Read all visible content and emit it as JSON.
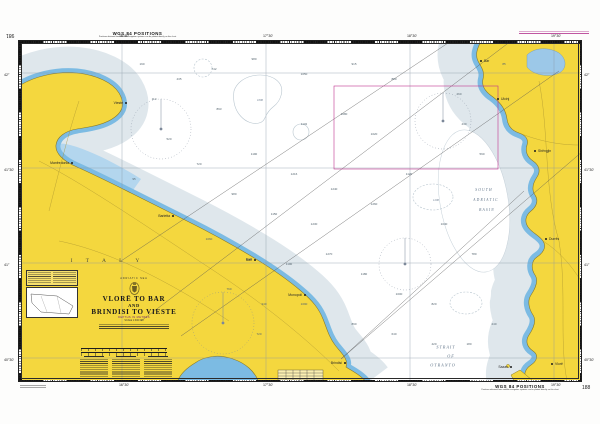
{
  "colors": {
    "land": "#F4D73E",
    "land_outline": "#8A7B28",
    "shallow": "#7CBBE3",
    "bay": "#B3D6EE",
    "midwater": "#DFE7EC",
    "deep": "#FFFFFF",
    "magenta": "#C0368F",
    "graticule": "#8795A3"
  },
  "margins": {
    "top_left_number": "981",
    "top_wgs": "WGS 84 POSITIONS",
    "top_wgs_sub": "Positions obtained from satellite navigation systems can be plotted directly on this chart",
    "bottom_wgs": "WGS 84 POSITIONS",
    "bottom_wgs_sub": "Positions obtained from satellite navigation systems can be plotted directly on this chart",
    "bottom_right_number": "188"
  },
  "title_block": {
    "region": "ADRIATIC SEA",
    "line1": "VLORË TO BAR",
    "line2": "AND",
    "line3": "BRINDISI TO VIESTE",
    "depths": "DEPTHS IN METRES",
    "scale": "SCALE 1:300 000"
  },
  "sea": {
    "strait": [
      "STRAIT",
      "OF",
      "OTRANTO"
    ],
    "basin": [
      "SOUTH",
      "ADRIATIC",
      "BASIN"
    ],
    "country_left": "I T A L Y",
    "contour_label_1": "1000",
    "contour_label_2": "1200"
  },
  "places": [
    {
      "name": "Vieste",
      "x": 104,
      "y": 59,
      "align": "l"
    },
    {
      "name": "Manfredonia",
      "x": 50,
      "y": 119,
      "align": "l"
    },
    {
      "name": "Barletta",
      "x": 151,
      "y": 172,
      "align": "l"
    },
    {
      "name": "Bari",
      "x": 233,
      "y": 216,
      "align": "l"
    },
    {
      "name": "Monopoli",
      "x": 283,
      "y": 251,
      "align": "l"
    },
    {
      "name": "Brindisi",
      "x": 323,
      "y": 319,
      "align": "l"
    },
    {
      "name": "Bar",
      "x": 459,
      "y": 17,
      "align": "r"
    },
    {
      "name": "Ulcinj",
      "x": 476,
      "y": 55,
      "align": "r"
    },
    {
      "name": "Shëngjin",
      "x": 513,
      "y": 107,
      "align": "r"
    },
    {
      "name": "Durrës",
      "x": 524,
      "y": 195,
      "align": "r"
    },
    {
      "name": "Vlorë",
      "x": 530,
      "y": 320,
      "align": "r"
    },
    {
      "name": "Sazan",
      "x": 489,
      "y": 323,
      "align": "l"
    }
  ],
  "graticule": {
    "meridians": [
      {
        "x": 103,
        "label": "16°30'"
      },
      {
        "x": 247,
        "label": "17°30'"
      },
      {
        "x": 391,
        "label": "18°30'"
      },
      {
        "x": 535,
        "label": "19°30'"
      }
    ],
    "parallels": [
      {
        "y": 32,
        "label": "42°"
      },
      {
        "y": 127,
        "label": "41°30'"
      },
      {
        "y": 222,
        "label": "41°"
      },
      {
        "y": 317,
        "label": "40°30'"
      }
    ]
  },
  "soundings": [
    [
      120,
      20,
      "190"
    ],
    [
      157,
      35,
      "435"
    ],
    [
      192,
      25,
      "742"
    ],
    [
      232,
      15,
      "980"
    ],
    [
      282,
      30,
      "1050"
    ],
    [
      332,
      20,
      "915"
    ],
    [
      372,
      35,
      "880"
    ],
    [
      197,
      65,
      "893"
    ],
    [
      282,
      80,
      "1132"
    ],
    [
      322,
      70,
      "1080"
    ],
    [
      352,
      90,
      "1020"
    ],
    [
      232,
      110,
      "1190"
    ],
    [
      272,
      130,
      "1216"
    ],
    [
      312,
      145,
      "1240"
    ],
    [
      352,
      160,
      "1260"
    ],
    [
      387,
      130,
      "1120"
    ],
    [
      422,
      180,
      "1040"
    ],
    [
      292,
      180,
      "1230"
    ],
    [
      252,
      170,
      "1150"
    ],
    [
      212,
      150,
      "980"
    ],
    [
      177,
      120,
      "720"
    ],
    [
      147,
      95,
      "520"
    ],
    [
      187,
      195,
      "1060"
    ],
    [
      227,
      215,
      "1120"
    ],
    [
      267,
      220,
      "1190"
    ],
    [
      307,
      210,
      "1270"
    ],
    [
      342,
      230,
      "1180"
    ],
    [
      377,
      250,
      "1000"
    ],
    [
      412,
      260,
      "820"
    ],
    [
      282,
      260,
      "1090"
    ],
    [
      242,
      260,
      "940"
    ],
    [
      207,
      245,
      "760"
    ],
    [
      332,
      280,
      "890"
    ],
    [
      372,
      290,
      "640"
    ],
    [
      412,
      300,
      "420"
    ],
    [
      442,
      80,
      "430"
    ],
    [
      452,
      210,
      "780"
    ],
    [
      437,
      50,
      "260"
    ],
    [
      132,
      55,
      "110"
    ],
    [
      112,
      135,
      "95"
    ],
    [
      237,
      290,
      "720"
    ],
    [
      447,
      300,
      "180"
    ],
    [
      482,
      20,
      "85"
    ],
    [
      460,
      110,
      "590"
    ],
    [
      472,
      280,
      "240"
    ]
  ]
}
